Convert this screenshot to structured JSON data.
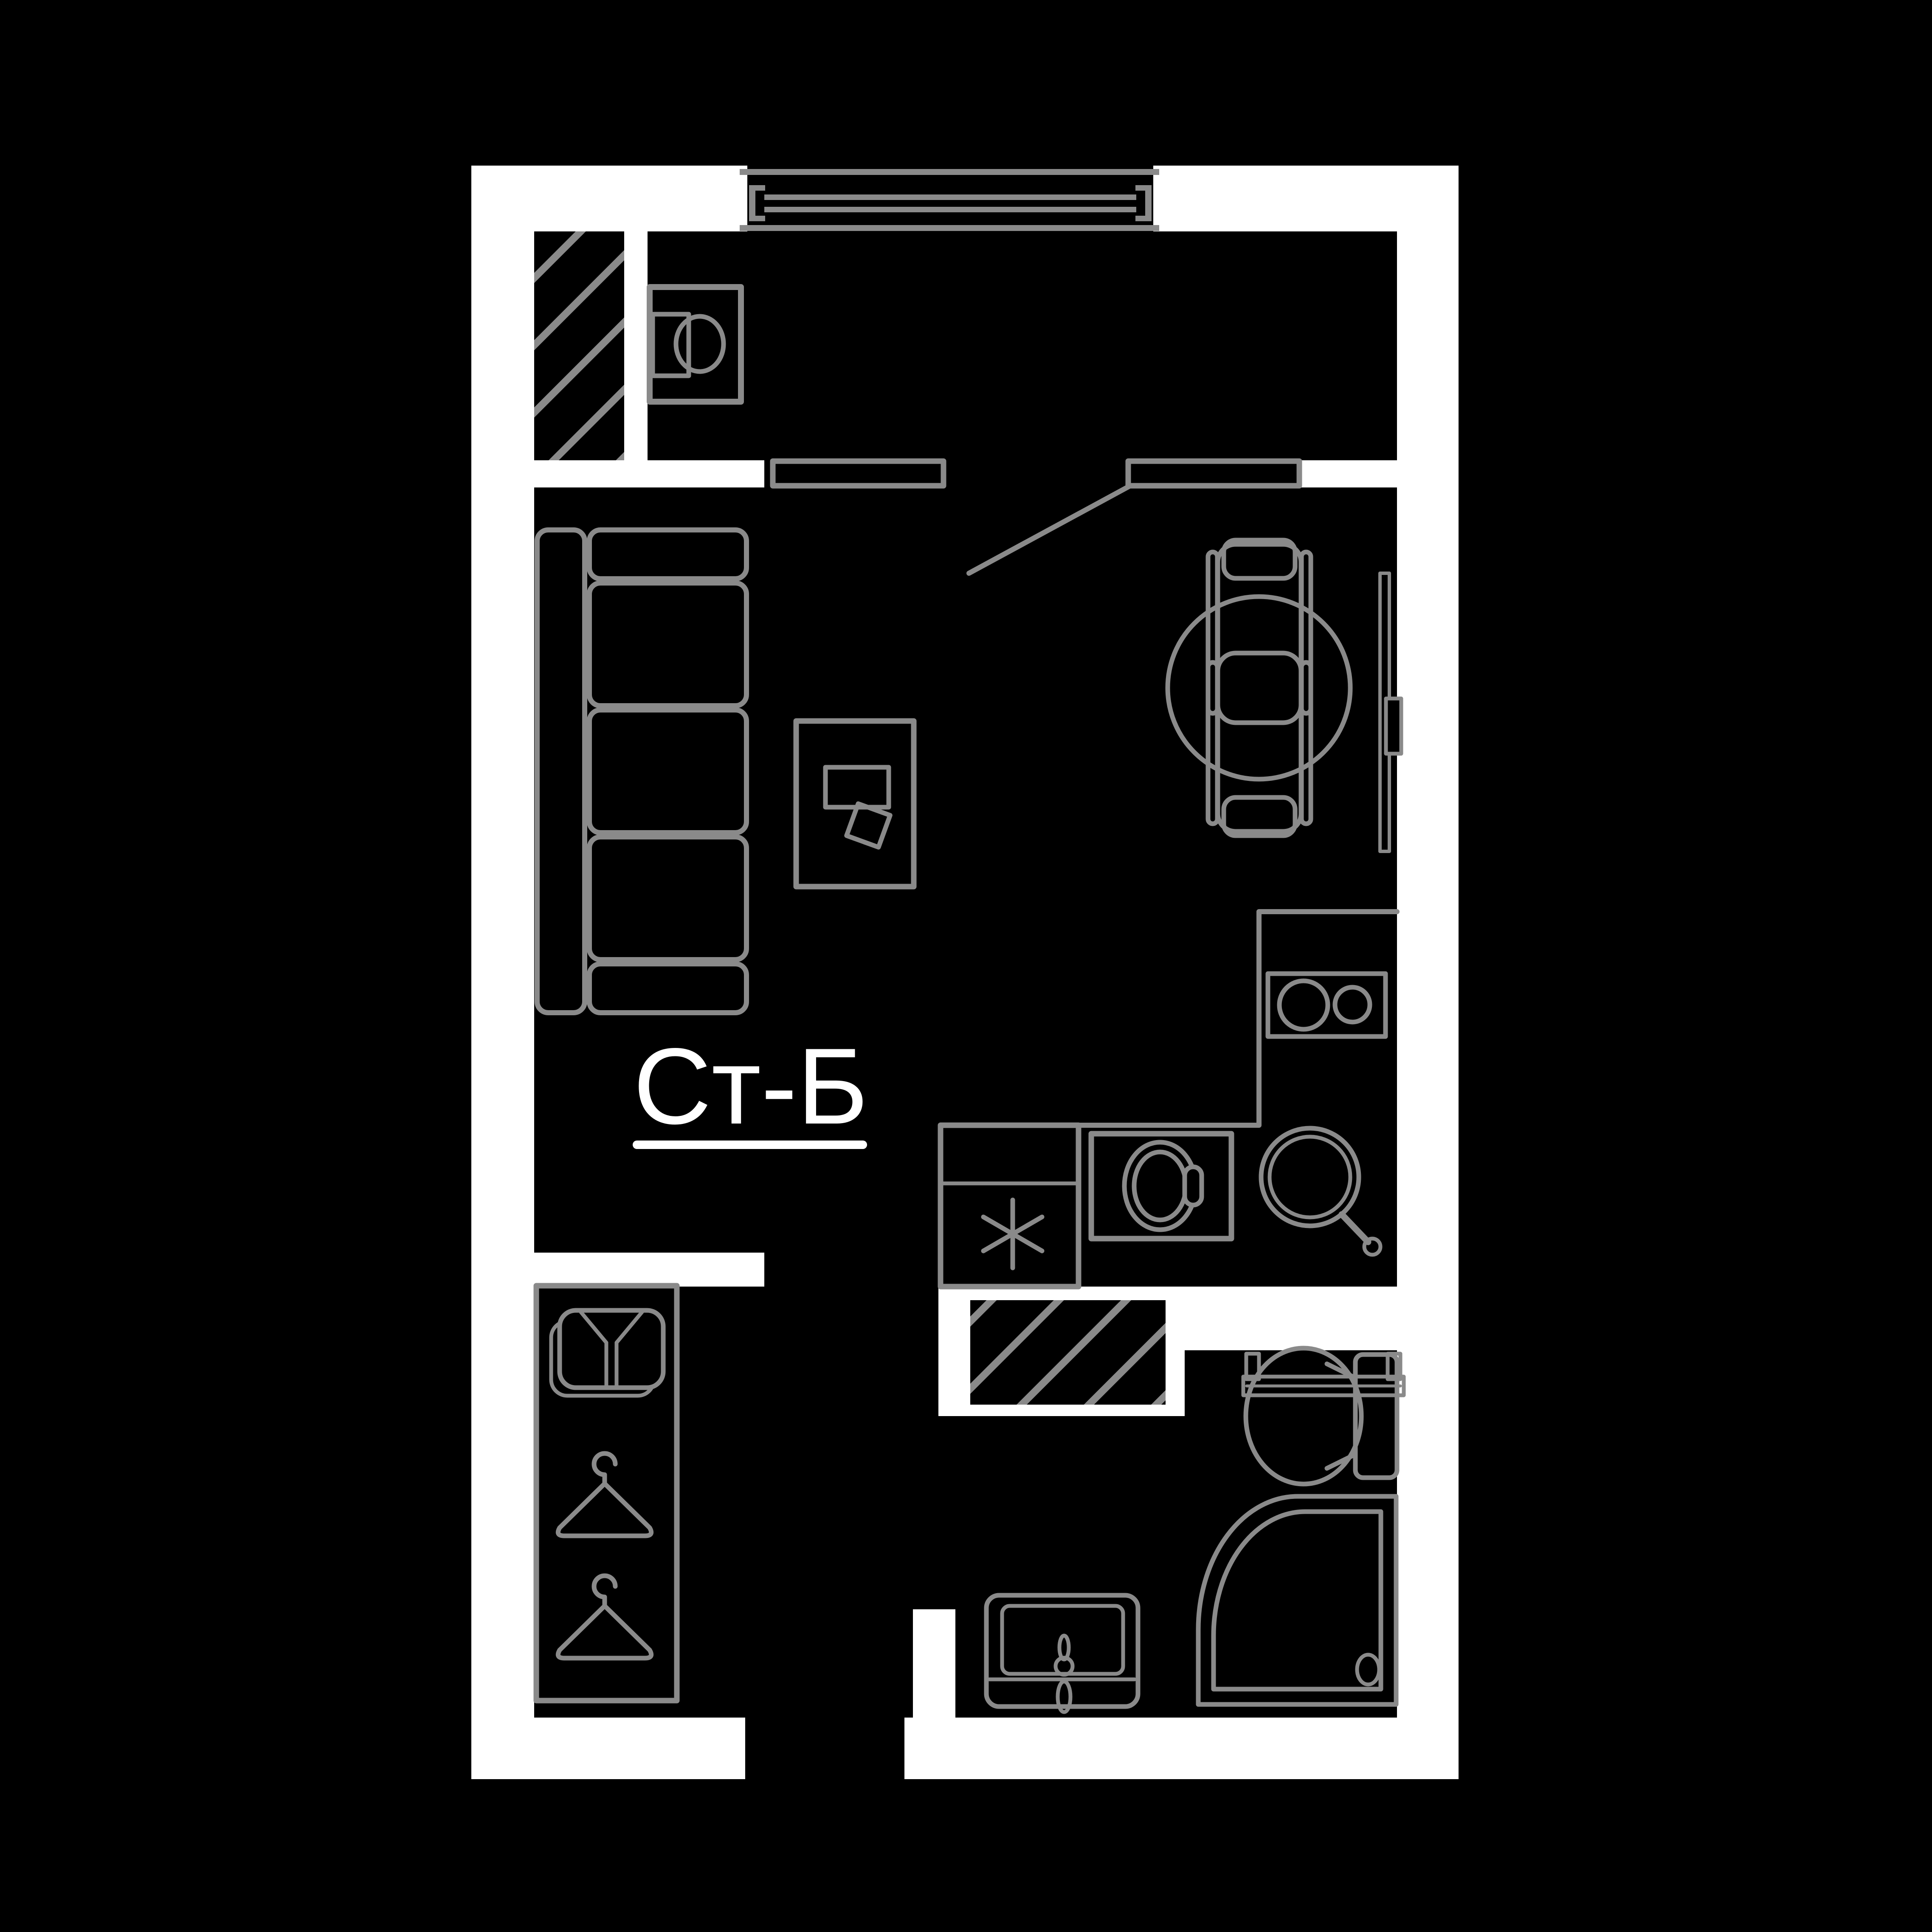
{
  "plan": {
    "unit_label": "Ст-Б"
  },
  "colors": {
    "background": "#000000",
    "wall": "#ffffff",
    "line": "#8a8a8a",
    "label": "#ffffff"
  },
  "elements": [
    "window",
    "entry-door",
    "door-casing",
    "ventilation-shaft",
    "washing-machine",
    "sofa",
    "coffee-table",
    "laptop",
    "dining-table",
    "chair",
    "tv-panel",
    "kitchen-counter",
    "fridge",
    "oven",
    "kitchen-sink",
    "hob",
    "towel-rail",
    "toilet",
    "shower-cabin",
    "bathroom-sink",
    "wardrobe",
    "shirt",
    "clothes-hanger",
    "entrance-opening"
  ]
}
